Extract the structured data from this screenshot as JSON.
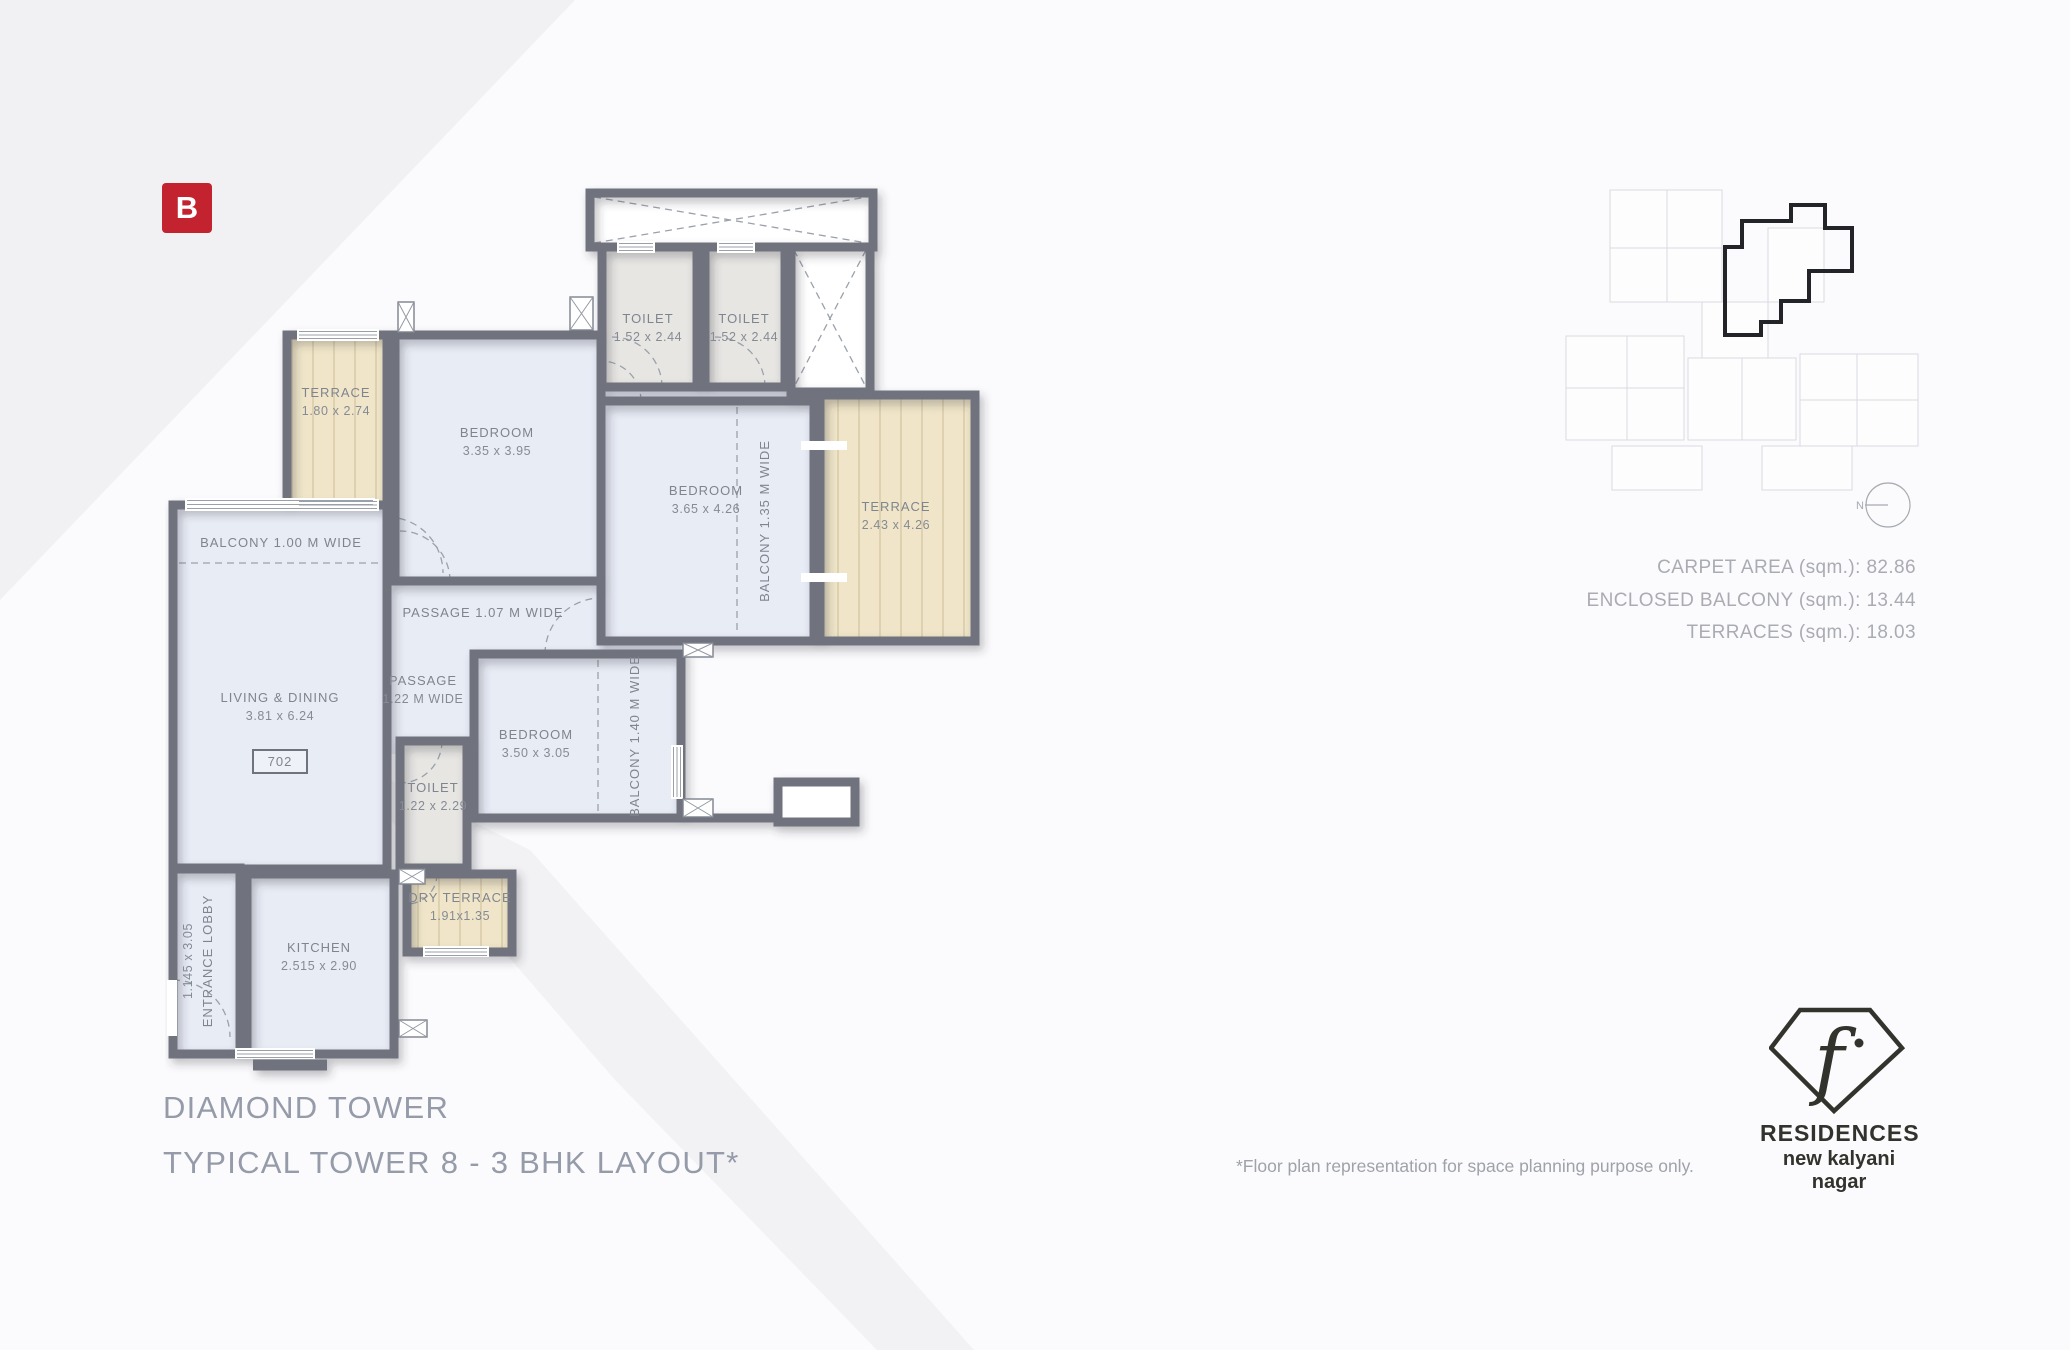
{
  "brand": {
    "logo_letter": "B"
  },
  "floor_plan": {
    "unit_number": "702",
    "rooms": {
      "toilet_a": {
        "name": "TOILET",
        "dims": "1.52 x 2.44"
      },
      "toilet_b": {
        "name": "TOILET",
        "dims": "1.52 x 2.44"
      },
      "terrace_small": {
        "name": "TERRACE",
        "dims": "1.80 x 2.74"
      },
      "bedroom_a": {
        "name": "BEDROOM",
        "dims": "3.35 x 3.95"
      },
      "bedroom_b": {
        "name": "BEDROOM",
        "dims": "3.65 x 4.26"
      },
      "terrace_large": {
        "name": "TERRACE",
        "dims": "2.43 x 4.26"
      },
      "living": {
        "name": "LIVING & DINING",
        "dims": "3.81 x 6.24"
      },
      "bedroom_c": {
        "name": "BEDROOM",
        "dims": "3.50 x 3.05"
      },
      "toilet_c": {
        "name": "TOILET",
        "dims": "1.22 x 2.29"
      },
      "dry_terrace": {
        "name": "DRY TERRACE",
        "dims": "1.91x1.35"
      },
      "kitchen": {
        "name": "KITCHEN",
        "dims": "2.515 x 2.90"
      },
      "entrance_lobby": {
        "name": "ENTRANCE LOBBY",
        "dims": "1.145 x 3.05"
      }
    },
    "annotations": {
      "balcony_100": "BALCONY 1.00 M WIDE",
      "balcony_135": "BALCONY 1.35 M WIDE",
      "balcony_140": "BALCONY 1.40 M WIDE",
      "passage_107": "PASSAGE 1.07 M WIDE",
      "passage_122_line1": "PASSAGE",
      "passage_122_line2": "1.22 M WIDE"
    }
  },
  "key_plan": {
    "compass_north_label": "N"
  },
  "area_statement": {
    "lines": [
      "CARPET AREA (sqm.): 82.86",
      "ENCLOSED BALCONY (sqm.): 13.44",
      "TERRACES (sqm.): 18.03"
    ]
  },
  "titles": {
    "line1": "DIAMOND TOWER",
    "line2": "TYPICAL TOWER 8 - 3 BHK LAYOUT*"
  },
  "disclaimer": "*Floor plan representation for space planning purpose only.",
  "footer_brand": {
    "glyph": "f",
    "name": "RESIDENCES",
    "location": "new kalyani nagar"
  },
  "colors": {
    "brand_red": "#c3232e",
    "wall": "#6f737d",
    "room_fill": "#e8ecf5",
    "toilet_fill": "#e7e6e3",
    "terrace_fill": "#f0e5c8",
    "title_text": "#959ba9",
    "plan_text": "#7f858f"
  }
}
